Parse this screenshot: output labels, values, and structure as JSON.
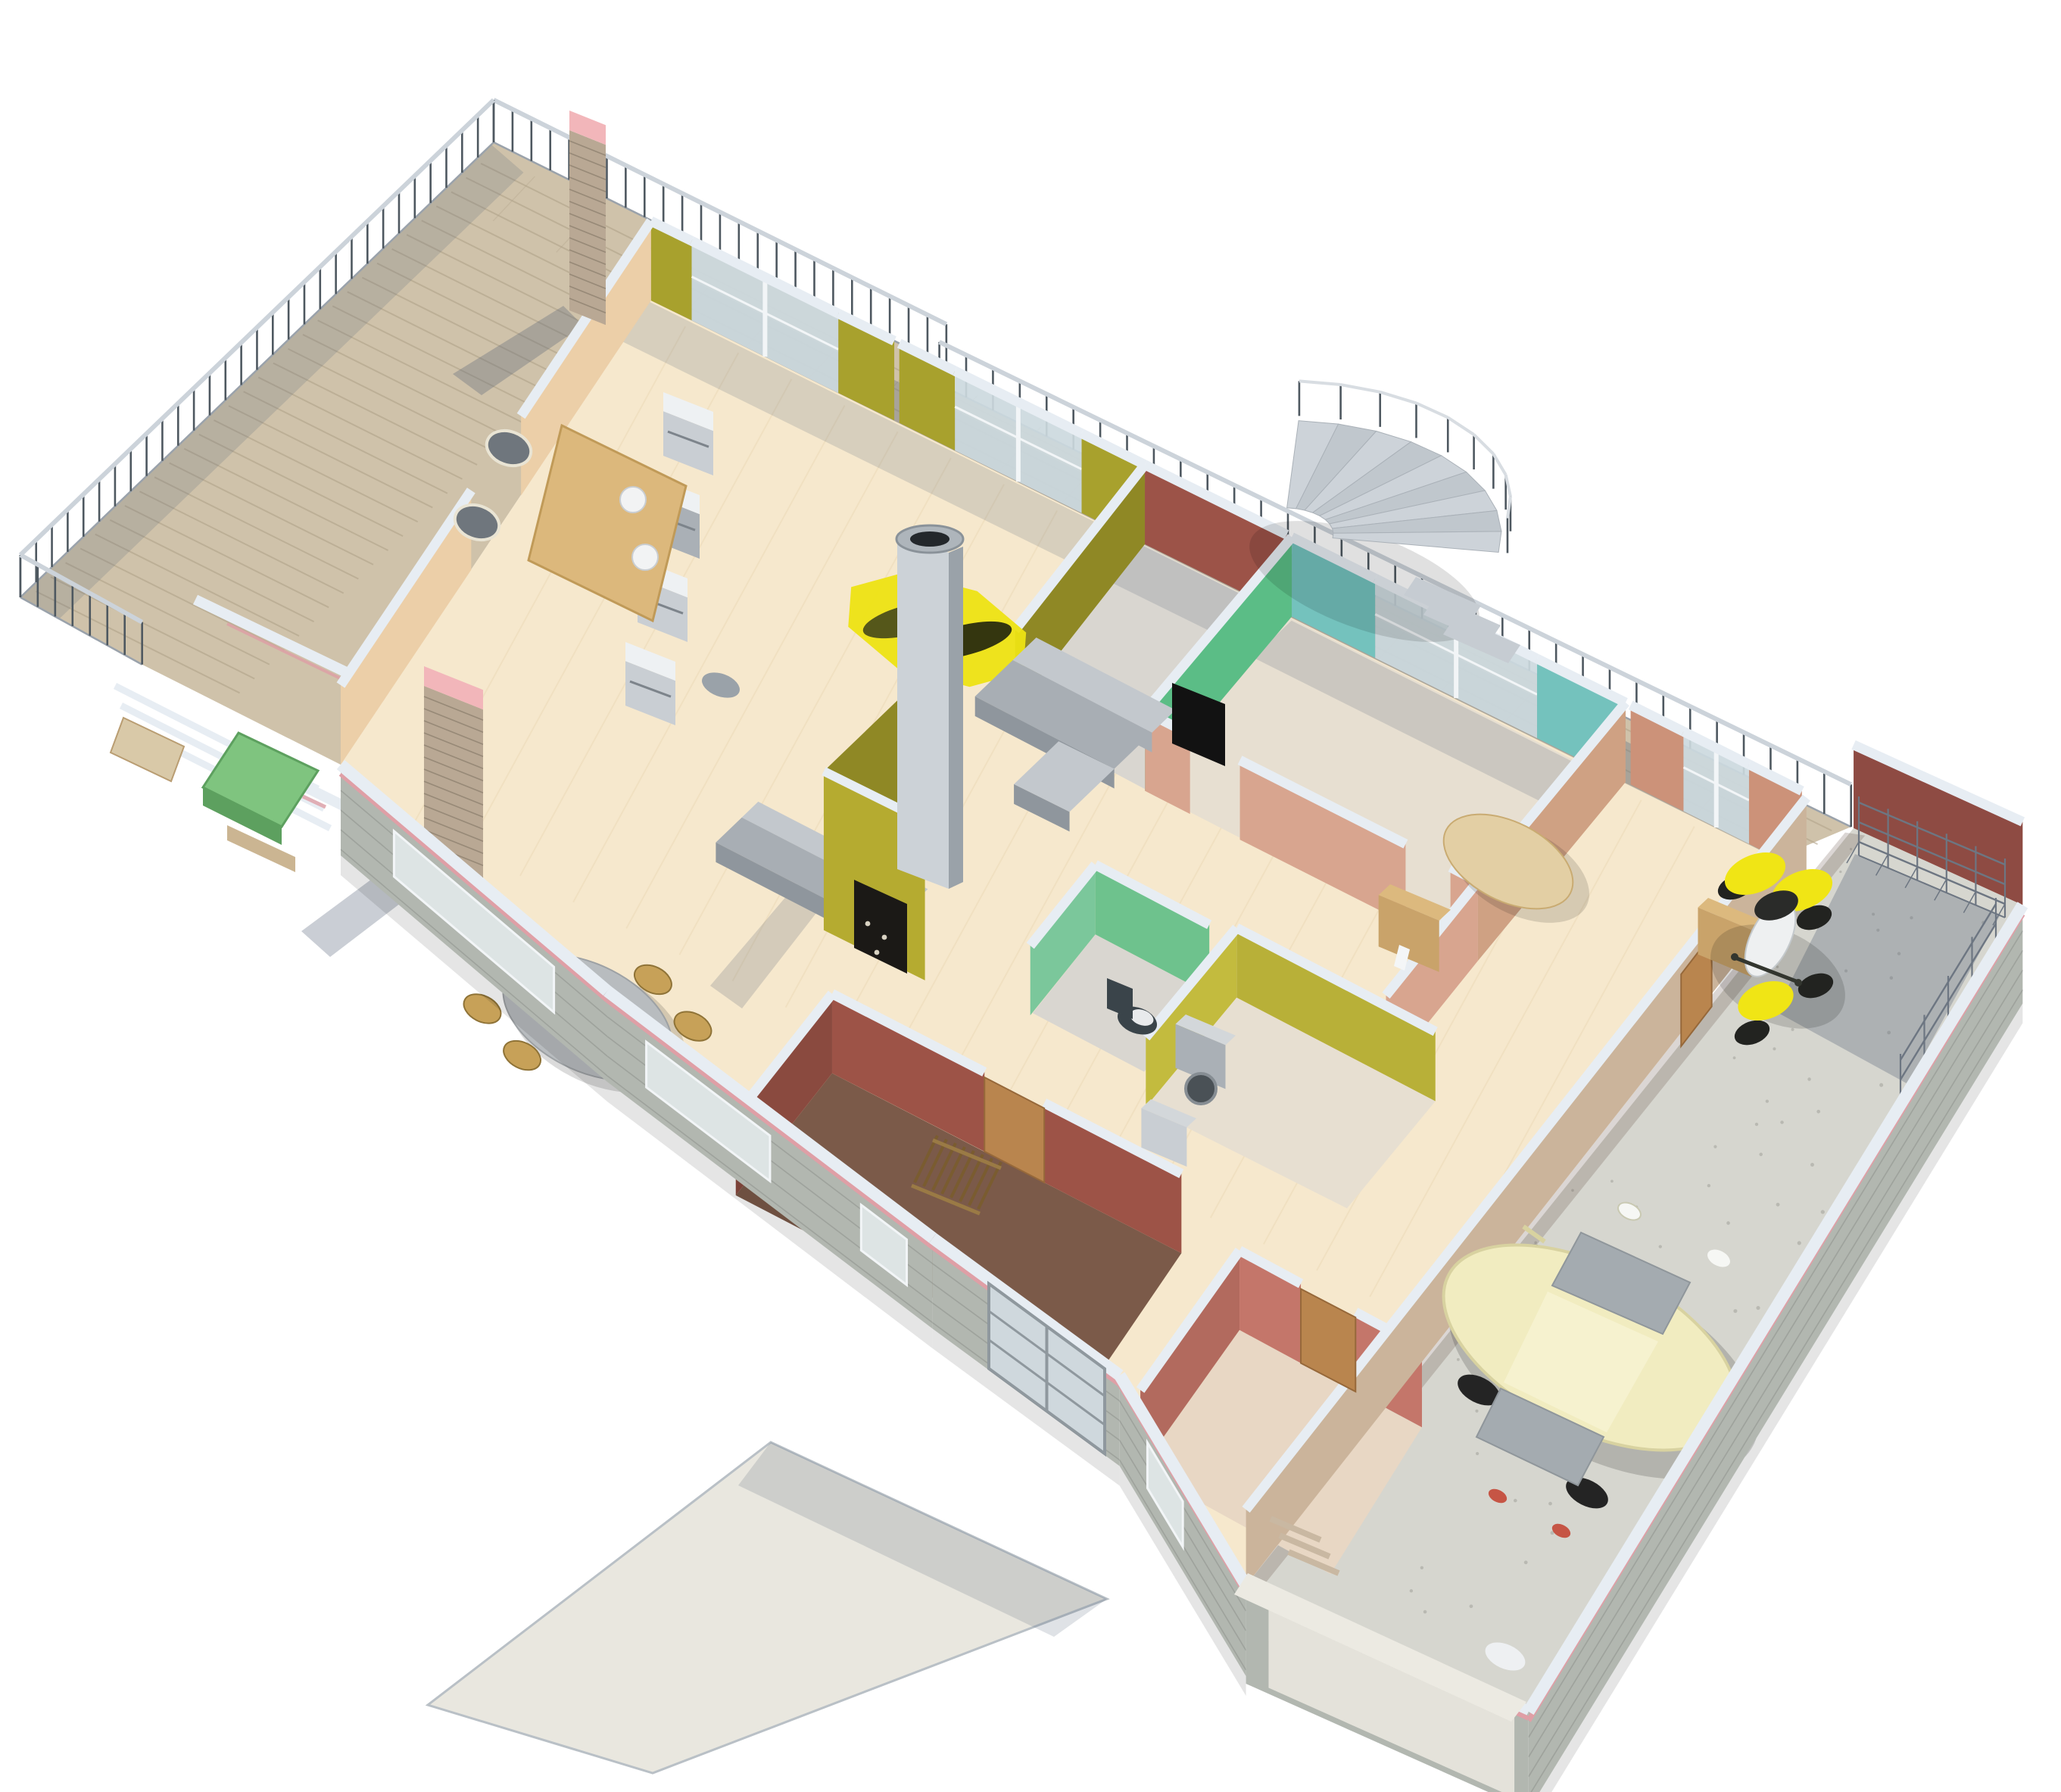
{
  "meta": {
    "title": "Isometric 3D floor plan rendering of a single-storey house with terrace and garage",
    "view": "axonometric-render",
    "visible_text": ""
  },
  "palette": {
    "bg": "#ffffff",
    "terraceTile": "#cfc2aa",
    "terraceStripe": "#b3a58c",
    "terraceLight": "#ddd2bd",
    "railPost": "#4e5860",
    "railTop": "#ccd3da",
    "wallCap": "#e7edf3",
    "wallCapShade": "#c9d2da",
    "brickFace": "#b2b7b0",
    "brickLine": "#9aa099",
    "pinkStripe": "#df9fa6",
    "peachWall": "#eccfa8",
    "oliveWall": "#a8a12d",
    "oliveDark": "#8f8825",
    "maroonWall": "#9c5348",
    "tealWall": "#74c2bd",
    "greenTV": "#5bbd86",
    "wcGreen": "#6ec28d",
    "utilOlive": "#b8b038",
    "salmonWall": "#cc9279",
    "entrySalmon": "#d8a58f",
    "red1Wall": "#9d5347",
    "red1Dark": "#8a4a3f",
    "red1Floor": "#7b5a49",
    "red2Wall": "#c4766a",
    "red2Dark": "#b26a5e",
    "red2Floor": "#e8d7c4",
    "parquet": "#f6e8cd",
    "parquetLine": "#ecd9b6",
    "carpet": "#e7dfd1",
    "stairFloor": "#d9d6d0",
    "glass": "#ccd9de",
    "glassFrame": "#f2f5f7",
    "woodDoor": "#b9854e",
    "woodLight": "#c9a36a",
    "woodTop": "#dcb97e",
    "steel": "#ccd2d7",
    "steelDark": "#9aa2a9",
    "applGray": "#c9ced3",
    "applDark": "#aab0b6",
    "sofaTop": "#c3c8cd",
    "sofaFront": "#a8aeb4",
    "sofaShade": "#8f969d",
    "tableGray": "#b8bcbf",
    "chairWood": "#c7a158",
    "rugYellow": "#ede313",
    "fanDark": "#55571a",
    "fanDarker": "#34360f",
    "fireOlive": "#b5ab30",
    "firebox": "#1b1916",
    "garageFloor": "#d6d6cf",
    "garageWallRed": "#8e4b43",
    "rack": "#6d7682",
    "carBody": "#f1ecc0",
    "carGlass": "#a4abb0",
    "carShade": "#d8d2a0",
    "quadYellow": "#f0e515",
    "quadBlack": "#222320",
    "quadWhite": "#eef0f1",
    "walkway": "#e9e7df",
    "toiletDark": "#3a444a",
    "shadow": "rgba(78,93,116,0.30)",
    "shadowSoft": "rgba(78,93,116,0.18)",
    "pinkTop": "#f2b6ba",
    "brickPillar": "#b9a894"
  },
  "scene": {
    "rooms": [
      {
        "id": "terrace",
        "wall": "railing",
        "floor": "terraceTile"
      },
      {
        "id": "living-room",
        "wall": "oliveWall",
        "floor": "parquet"
      },
      {
        "id": "dining-area",
        "wall": "peachWall",
        "floor": "parquet"
      },
      {
        "id": "stair-hall",
        "wall": "maroonWall",
        "floor": "stairFloor"
      },
      {
        "id": "bedroom-teal",
        "wall": "tealWall",
        "floor": "carpet"
      },
      {
        "id": "bedroom-salmon",
        "wall": "salmonWall",
        "floor": "parquet"
      },
      {
        "id": "wc",
        "wall": "wcGreen",
        "floor": "stairFloor"
      },
      {
        "id": "utility-room",
        "wall": "utilOlive",
        "floor": "carpet"
      },
      {
        "id": "entry-hall",
        "wall": "entrySalmon",
        "floor": "parquet"
      },
      {
        "id": "bedroom-red",
        "wall": "red1Wall",
        "floor": "red1Floor"
      },
      {
        "id": "bedroom-rose",
        "wall": "red2Wall",
        "floor": "red2Floor"
      },
      {
        "id": "garage",
        "wall": "garageWallRed",
        "floor": "garageFloor"
      }
    ],
    "furniture": [
      "kitchen-appliances",
      "yellow-rug",
      "ceiling-fan",
      "sectional-sofa",
      "sofa",
      "fireplace",
      "chimney",
      "dining-table",
      "dining-chairs",
      "spiral-staircase",
      "tv-panel",
      "coffee-table",
      "wardrobe",
      "washing-machine",
      "dryer",
      "toilet",
      "shoe-rack",
      "outdoor-table",
      "outdoor-chairs",
      "planter-box",
      "garden-bench",
      "storage-racks",
      "front-door",
      "room-doors"
    ],
    "vehicles": [
      {
        "id": "car",
        "color": "carBody"
      },
      {
        "id": "quad-bike",
        "color": "quadYellow"
      }
    ]
  }
}
